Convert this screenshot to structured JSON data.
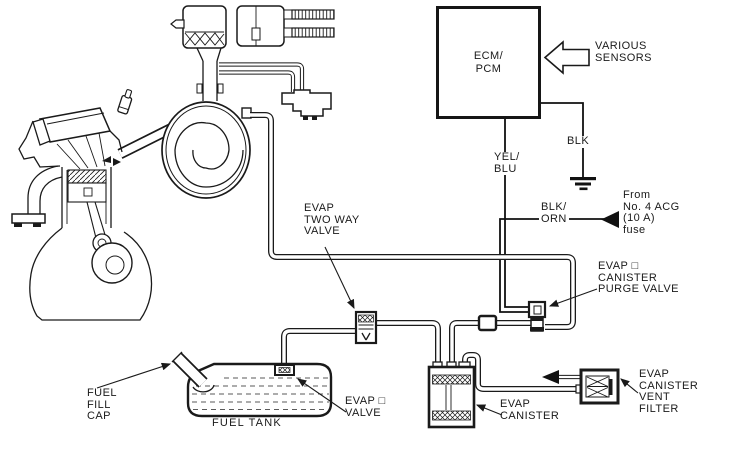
{
  "colors": {
    "ink": "#1a1a1a",
    "background": "#ffffff"
  },
  "ecm": {
    "label": "ECM/\nPCM"
  },
  "sensors_arrow": {
    "label": "VARIOUS\nSENSORS"
  },
  "wires": {
    "yel_blu": "YEL/\nBLU",
    "blk": "BLK",
    "blk_orn": "BLK/\nORN",
    "fuse": "From\nNo. 4 ACG\n(10 A)\nfuse"
  },
  "components": {
    "two_way_valve": "EVAP\nTWO WAY\nVALVE",
    "purge_valve": "EVAP □\nCANISTER\nPURGE VALVE",
    "canister": "EVAP\nCANISTER",
    "vent_filter": "EVAP\nCANISTER\nVENT\nFILTER",
    "evap_valve": "EVAP □\nVALVE",
    "fuel_tank": "FUEL TANK",
    "fuel_fill_cap": "FUEL\nFILL\nCAP"
  }
}
